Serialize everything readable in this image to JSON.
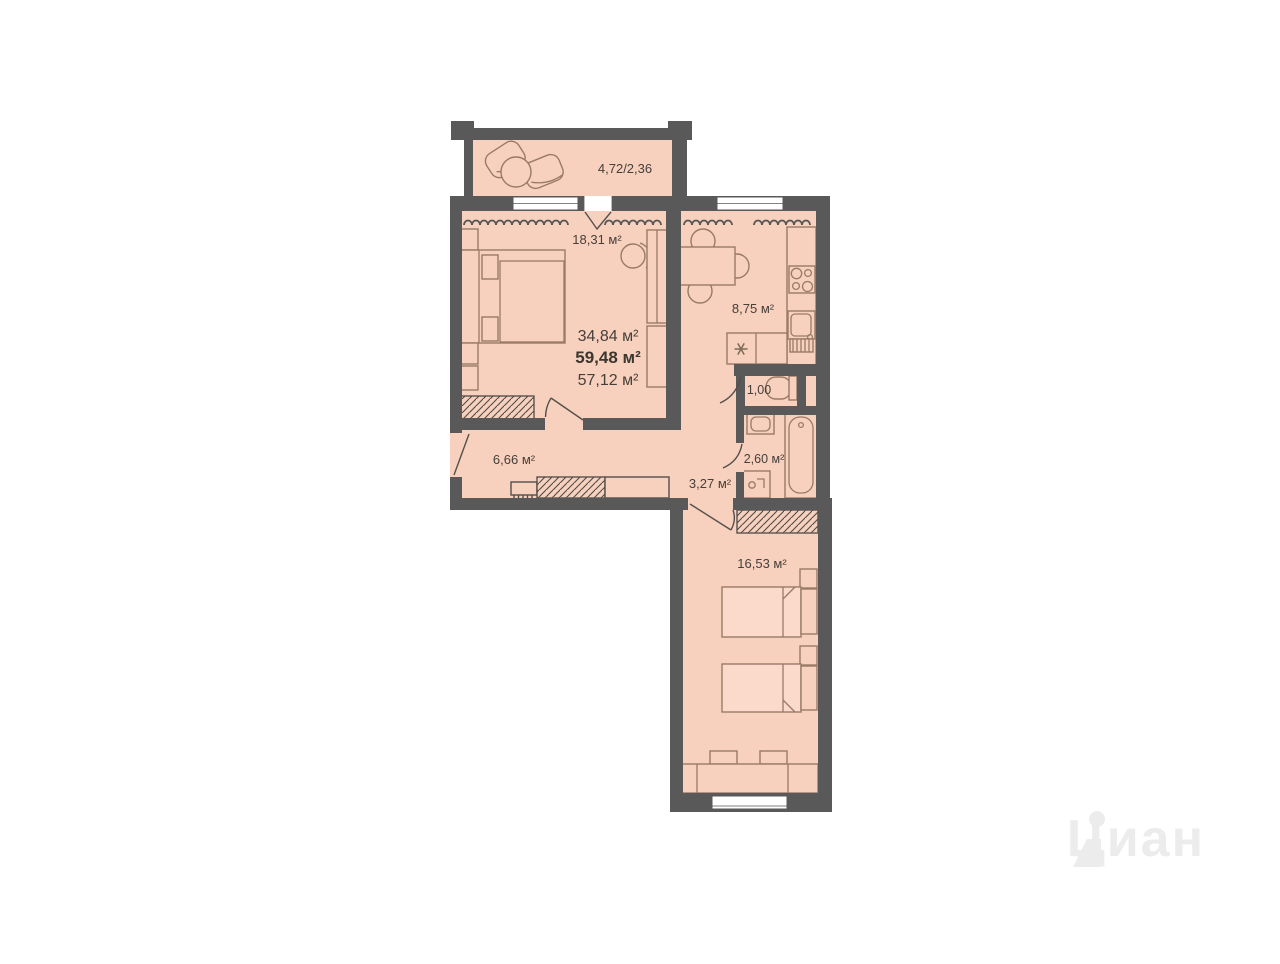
{
  "plan": {
    "type": "apartment-floor-plan",
    "rooms": {
      "balcony": "4,72/2,36",
      "bedroom": "18,31 м²",
      "kitchen": "8,75 м²",
      "wc": "1,00",
      "bathroom": "2,60 м²",
      "corridor": "3,27 м²",
      "hallway": "6,66 м²",
      "bedroom2": "16,53 м²"
    },
    "areas": {
      "living": "34,84 м²",
      "total": "59,48 м²",
      "reduced": "57,12 м²"
    }
  },
  "watermark": {
    "text": "Циан"
  },
  "palette": {
    "wall": "#595959",
    "floor": "#f8d0be",
    "furniture_outline": "#987b67",
    "label_text": "#45403a",
    "background": "#ffffff",
    "watermark": "#ececec"
  },
  "icons": {
    "lounge_chair": "balcony-lounge-chair-icon",
    "double_bed": "double-bed-icon",
    "single_beds": "single-bed-icon",
    "dining_table": "dining-table-icon",
    "stove": "stove-icon",
    "kitchen_sink": "kitchen-sink-icon",
    "toilet": "toilet-icon",
    "bathtub": "bathtub-icon",
    "washer": "washing-machine-icon",
    "wardrobe": "wardrobe-icon",
    "radiator": "radiator-wave-icon"
  }
}
